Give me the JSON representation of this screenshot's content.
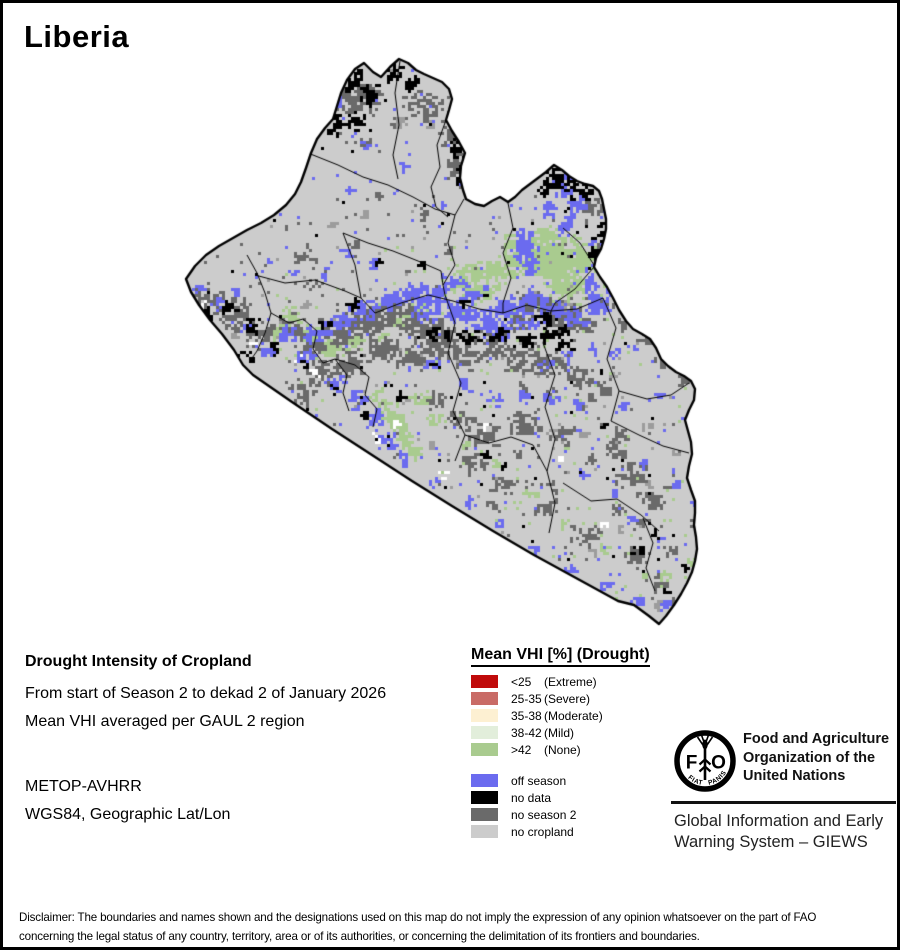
{
  "page": {
    "title": "Liberia"
  },
  "info_block": {
    "heading": "Drought Intensity of Cropland",
    "period_line": "From start of Season 2 to dekad 2 of January 2026",
    "method_line": "Mean VHI averaged per GAUL 2 region",
    "sensor": "METOP-AVHRR",
    "projection": "WGS84, Geographic Lat/Lon"
  },
  "legend": {
    "title": "Mean VHI [%] (Drought)",
    "drought_classes": [
      {
        "value": "<25",
        "qualifier": "(Extreme)",
        "color": "#c00a0a"
      },
      {
        "value": "25-35",
        "qualifier": "(Severe)",
        "color": "#c96b66"
      },
      {
        "value": "35-38",
        "qualifier": "(Moderate)",
        "color": "#fdf0d2"
      },
      {
        "value": "38-42",
        "qualifier": "(Mild)",
        "color": "#e2eedb"
      },
      {
        "value": ">42",
        "qualifier": "(None)",
        "color": "#a9cb8f"
      }
    ],
    "other_classes": [
      {
        "label": "off season",
        "color": "#6b6bef"
      },
      {
        "label": "no data",
        "color": "#000000"
      },
      {
        "label": "no season 2",
        "color": "#6a6a6a"
      },
      {
        "label": "no cropland",
        "color": "#cccccc"
      }
    ]
  },
  "branding": {
    "org_name_lines": [
      "Food and Agriculture",
      "Organization of the",
      "United Nations"
    ],
    "giews_lines": [
      "Global Information and Early",
      "Warning System – GIEWS"
    ],
    "logo": {
      "left_letter": "F",
      "right_letter": "O",
      "motto_left": "FIAT",
      "motto_right": "PANIS"
    }
  },
  "disclaimer": {
    "line1": "Disclaimer: The boundaries and names shown and the designations used on this map do not imply the expression of any opinion whatsoever on the part of FAO",
    "line2": "concerning the legal status of any country, territory, area or of its authorities, or concerning the delimitation of its frontiers and boundaries."
  }
}
